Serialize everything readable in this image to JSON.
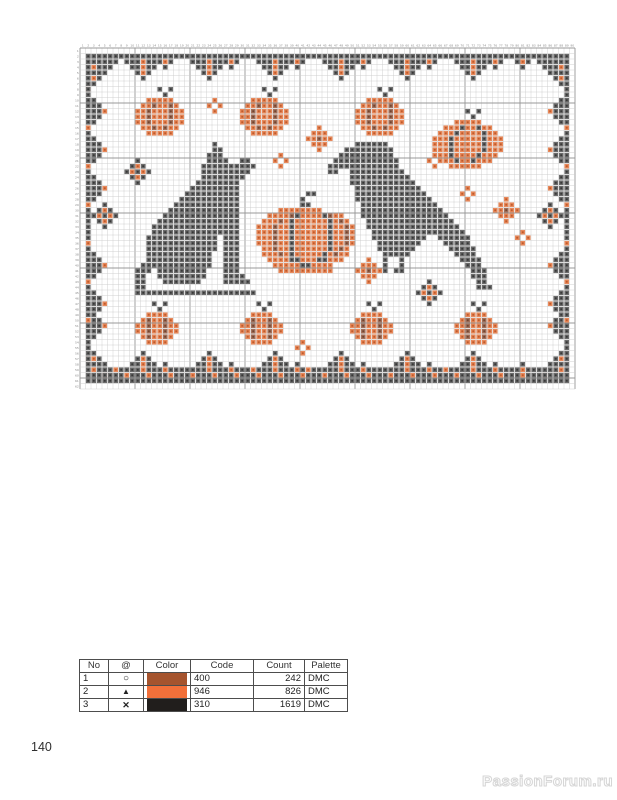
{
  "page": {
    "number": "140",
    "watermark": "PassionForum.ru"
  },
  "legend": {
    "headers": [
      "No",
      "@",
      "Color",
      "Code",
      "Count",
      "Palette"
    ],
    "rows": [
      {
        "no": "1",
        "symbol": "○",
        "color": "#A5542E",
        "code": "400",
        "count": "242",
        "palette": "DMC"
      },
      {
        "no": "2",
        "symbol": "▲",
        "color": "#F2703A",
        "code": "946",
        "count": "826",
        "palette": "DMC"
      },
      {
        "no": "3",
        "symbol": "✕",
        "color": "#211E1C",
        "code": "310",
        "count": "1619",
        "palette": "DMC"
      }
    ]
  },
  "pattern": {
    "cols": 90,
    "rows": 62,
    "cell": 5.5,
    "grid": {
      "light": "#cccccc",
      "bold": "#989898",
      "number_color": "#8a8a8a"
    },
    "palette": {
      "X": {
        "bg": "#6B6B6B",
        "fg": "#373737"
      },
      "A": {
        "bg": "#E8895B",
        "fg": "#BF5A2B"
      },
      "O": {
        "bg": "#A3705A",
        "fg": "#6E4430"
      }
    },
    "runs": [
      {
        "row": 1,
        "c0": 1,
        "c1": 88,
        "accent": 0
      },
      {
        "row": 58,
        "c0": 2,
        "c1": 87,
        "accent": 5
      },
      {
        "row": 59,
        "c0": 1,
        "c1": 88,
        "accent": 4
      },
      {
        "row": 60,
        "c0": 1,
        "c1": 88,
        "accent": 0
      },
      {
        "col": 1,
        "r0": 1,
        "r1": 60,
        "accent": 7
      },
      {
        "col": 88,
        "r0": 1,
        "r1": 60,
        "accent": 7
      }
    ],
    "shapes": {
      "corner_tl": [
        "XXXXXXX",
        "XXXXXX.",
        "XAXXX..",
        "XXXX...",
        "XAX....",
        "XX.....",
        "X......"
      ],
      "corner_tr": [
        "XXXXXXX",
        ".XXXXXX",
        "..XXXAX",
        "...XXXX",
        "....XAX",
        ".....XX",
        "......X"
      ],
      "corner_bl": [
        "X......",
        "XX.....",
        "XAX....",
        "XXXX...",
        "XAXXX..",
        "XXXXXX.",
        "XXXXXXX"
      ],
      "corner_br": [
        "......X",
        ".....XX",
        "....XAX",
        "...XXXX",
        "..XXXAX",
        ".XXXXXX",
        "XXXXXXX"
      ],
      "pendant_big": [
        "XXXAXXX",
        ".XXAXX.",
        "..XAX..",
        "...X..."
      ],
      "pendant_small": [
        "XAX",
        ".X."
      ],
      "tri_big": [
        "...X...",
        "..XAX..",
        ".XXAXX.",
        "XXXAXXX"
      ],
      "tri_small": [
        ".X.",
        "XAX"
      ],
      "left_unit": [
        "X..",
        "XX.",
        "XXA",
        "XX.",
        "X.."
      ],
      "right_unit": [
        "..X",
        ".XX",
        "AXX",
        ".XX",
        "..X"
      ],
      "d1": [
        "..A..",
        ".AAA.",
        "AAOAA",
        ".AAA.",
        "..A.."
      ],
      "d2": [
        "..X..",
        ".XAX.",
        "XAXAX",
        ".XAX.",
        "..X.."
      ],
      "d3": [
        ".A.",
        "A.A",
        ".A."
      ],
      "pumpkin_med": [
        "....X.X...",
        ".....X....",
        "..AAAAA...",
        ".AAOAAOA..",
        "AAOAAAOAA.",
        "AAOAAAOAA.",
        "AAOAAAOAA.",
        ".AAOAOAA..",
        "..AAAAA..."
      ],
      "pumpkin_small": [
        "...X.X...",
        "....X....",
        "..AAAA...",
        ".AOAAOA..",
        "AAOAAOAA.",
        "AAOAAOAA.",
        ".AOAAOA..",
        "..AAAA..."
      ],
      "pumpkin_large_tr": [
        "......X.X....",
        ".......X.....",
        "....AAAAA....",
        "..AAAXAAXAA..",
        ".AAAXAAAAXAA.",
        "AAAXAAAAAXAAA",
        "AAAXAAAAAXAAA",
        "AAAXAAAAAXAAA",
        ".AAXAAAAXAAA.",
        "..AAXAAXAAA..",
        "...AAAAAA...."
      ],
      "pumpkin_big": [
        ".........XX.......",
        "........X.........",
        "........XX........",
        "....AAAAAAAA......",
        "..AAAAOXAAAAXOAA..",
        ".AAAOAXAAAAAAXAOA.",
        "AAAOAAXAAAAAAXAAOA",
        "AAAOAAXAAAAAAXAAOA",
        "AAAOAAXAAAAAAXAAOA",
        "AAAOAAXAAAAAAXAAOA",
        ".AAOAAXAAAAAAXAOA.",
        ".AAAOAXAAAAAXAOAA.",
        "..AAAAXXAAAXXAAA..",
        "...AAAAAXXAAAA....",
        "....AAAAAAAAAA...."
      ],
      "cat": [
        "..............X.........",
        "..............XX........",
        ".............XXX........",
        ".............XXXX..XX...",
        "............XXXXXXXXXX..",
        "............XXXXXXXXX...",
        "............XXXXXXXX....",
        "...........XXXXXXXX.....",
        "..........XXXXXXXXX.....",
        ".........XXXXXXXXXX.....",
        "........XXXXXXXXXXX.....",
        ".......XXXXXXXXXXXX.....",
        "......XXXXXXXXXXXXX.....",
        ".....XXXXXXXXXXXXXX.....",
        "....XXXXXXXXXXXXXXX.....",
        "...XXXXXXXXXXXXXXXX.....",
        "...XXXXXXXXXXXXXXXX.....",
        "..XXXXXXXXXXXXX.XXX.....",
        "..XXXXXXXXXXXXX.XXX.....",
        "..XXXXXXXXXXXXX.XXX.....",
        "..XXXXXXXXXXXX..XXX.....",
        "..XXXXXXXXXXXX..XXX.....",
        ".XXXXXXXXXXXXX..XXX.....",
        "XXX.XXXXXXXXX...XXX.....",
        "XX..XXXXXXXXX...XXXX....",
        "XX...XXXXXXX....XXXXX...",
        "XX......................",
        "XXXXXXXXXXXXXXXXXXXXXX.."
      ],
      "crow": [
        ".....XXXXXX....................",
        "...XXXXXXXXX...................",
        "..XXXXXXXXXX...................",
        ".XXXXXXXXXXXX..................",
        "XXXXXXXXXXXXX..................",
        "XX..XXXXXXXXXX.................",
        "....XXXXXXXXXXX................",
        "....XXXXXXXXXXXX...............",
        ".....XXXXXXXXXXXX..............",
        ".....XXXXXXXXXXXXX.............",
        ".....XXXXXXXXXXXXXX............",
        "......XXXXXXXXXXXXXX...........",
        "......XXXXXXXXXXXXXXX..........",
        "......XXXXXXXXXXXXXXXX.........",
        ".......XXXXXXXXXXXXXXXX........",
        ".......XXXXXXXXXXXXXXXXX.......",
        "........XXXXXXXXXXXXXXXXX......",
        "........XXXXXXXXXX..XXXXXX.....",
        ".........XXXXXXXX....XXXXX.....",
        ".........XXXXXXX......XXXXX....",
        "..........XXXXX........XXXX....",
        "..........X..X..........XXXX...",
        "..........X..X...........XXX...",
        ".........XX.XX............XXX..",
        "..........................XXX..",
        "...........................XX..",
        "...........................XXX."
      ]
    },
    "placements": [
      {
        "shape": "corner_tl",
        "col": 1,
        "row": 1
      },
      {
        "shape": "corner_tr",
        "col": 82,
        "row": 1
      },
      {
        "shape": "corner_bl",
        "col": 1,
        "row": 54
      },
      {
        "shape": "corner_br",
        "col": 82,
        "row": 54
      },
      {
        "shape": "pendant_big",
        "col": 8,
        "row": 2
      },
      {
        "shape": "pendant_big",
        "col": 20,
        "row": 2
      },
      {
        "shape": "pendant_big",
        "col": 32,
        "row": 2
      },
      {
        "shape": "pendant_big",
        "col": 44,
        "row": 2
      },
      {
        "shape": "pendant_big",
        "col": 56,
        "row": 2
      },
      {
        "shape": "pendant_big",
        "col": 68,
        "row": 2
      },
      {
        "shape": "pendant_small",
        "col": 14,
        "row": 2
      },
      {
        "shape": "pendant_small",
        "col": 26,
        "row": 2
      },
      {
        "shape": "pendant_small",
        "col": 38,
        "row": 2
      },
      {
        "shape": "pendant_small",
        "col": 50,
        "row": 2
      },
      {
        "shape": "pendant_small",
        "col": 62,
        "row": 2
      },
      {
        "shape": "pendant_small",
        "col": 74,
        "row": 2
      },
      {
        "shape": "pendant_small",
        "col": 79,
        "row": 2
      },
      {
        "shape": "tri_big",
        "col": 8,
        "row": 55
      },
      {
        "shape": "tri_big",
        "col": 20,
        "row": 55
      },
      {
        "shape": "tri_big",
        "col": 32,
        "row": 55
      },
      {
        "shape": "tri_big",
        "col": 44,
        "row": 55
      },
      {
        "shape": "tri_big",
        "col": 56,
        "row": 55
      },
      {
        "shape": "tri_big",
        "col": 68,
        "row": 55
      },
      {
        "shape": "tri_small",
        "col": 14,
        "row": 57
      },
      {
        "shape": "tri_small",
        "col": 26,
        "row": 57
      },
      {
        "shape": "tri_small",
        "col": 38,
        "row": 57
      },
      {
        "shape": "tri_small",
        "col": 50,
        "row": 57
      },
      {
        "shape": "tri_small",
        "col": 62,
        "row": 57
      },
      {
        "shape": "tri_small",
        "col": 74,
        "row": 57
      },
      {
        "shape": "tri_small",
        "col": 79,
        "row": 57
      },
      {
        "shape": "left_unit",
        "col": 2,
        "row": 9
      },
      {
        "shape": "left_unit",
        "col": 2,
        "row": 16
      },
      {
        "shape": "left_unit",
        "col": 2,
        "row": 23
      },
      {
        "shape": "left_unit",
        "col": 2,
        "row": 37
      },
      {
        "shape": "left_unit",
        "col": 2,
        "row": 44
      },
      {
        "shape": "left_unit",
        "col": 2,
        "row": 48
      },
      {
        "shape": "right_unit",
        "col": 85,
        "row": 9
      },
      {
        "shape": "right_unit",
        "col": 85,
        "row": 16
      },
      {
        "shape": "right_unit",
        "col": 85,
        "row": 23
      },
      {
        "shape": "right_unit",
        "col": 85,
        "row": 37
      },
      {
        "shape": "right_unit",
        "col": 85,
        "row": 44
      },
      {
        "shape": "right_unit",
        "col": 85,
        "row": 48
      },
      {
        "shape": "d2",
        "col": 2,
        "row": 28
      },
      {
        "shape": "d2",
        "col": 83,
        "row": 28
      },
      {
        "shape": "pumpkin_med",
        "col": 10,
        "row": 7
      },
      {
        "shape": "pumpkin_med",
        "col": 29,
        "row": 7
      },
      {
        "shape": "pumpkin_med",
        "col": 50,
        "row": 7
      },
      {
        "shape": "pumpkin_large_tr",
        "col": 64,
        "row": 11
      },
      {
        "shape": "pumpkin_big",
        "col": 32,
        "row": 26
      },
      {
        "shape": "pumpkin_small",
        "col": 10,
        "row": 46
      },
      {
        "shape": "pumpkin_small",
        "col": 29,
        "row": 46
      },
      {
        "shape": "pumpkin_small",
        "col": 49,
        "row": 46
      },
      {
        "shape": "pumpkin_small",
        "col": 68,
        "row": 46
      },
      {
        "shape": "cat",
        "col": 10,
        "row": 17
      },
      {
        "shape": "crow",
        "col": 45,
        "row": 17
      },
      {
        "shape": "d3",
        "col": 23,
        "row": 9
      },
      {
        "shape": "d3",
        "col": 35,
        "row": 19
      },
      {
        "shape": "d3",
        "col": 63,
        "row": 19
      },
      {
        "shape": "d3",
        "col": 69,
        "row": 25
      },
      {
        "shape": "d3",
        "col": 79,
        "row": 33
      },
      {
        "shape": "d3",
        "col": 39,
        "row": 53
      },
      {
        "shape": "d1",
        "col": 41,
        "row": 14
      },
      {
        "shape": "d1",
        "col": 75,
        "row": 27
      },
      {
        "shape": "d1",
        "col": 50,
        "row": 38
      },
      {
        "shape": "d2",
        "col": 8,
        "row": 20
      },
      {
        "shape": "d2",
        "col": 61,
        "row": 42
      }
    ]
  }
}
